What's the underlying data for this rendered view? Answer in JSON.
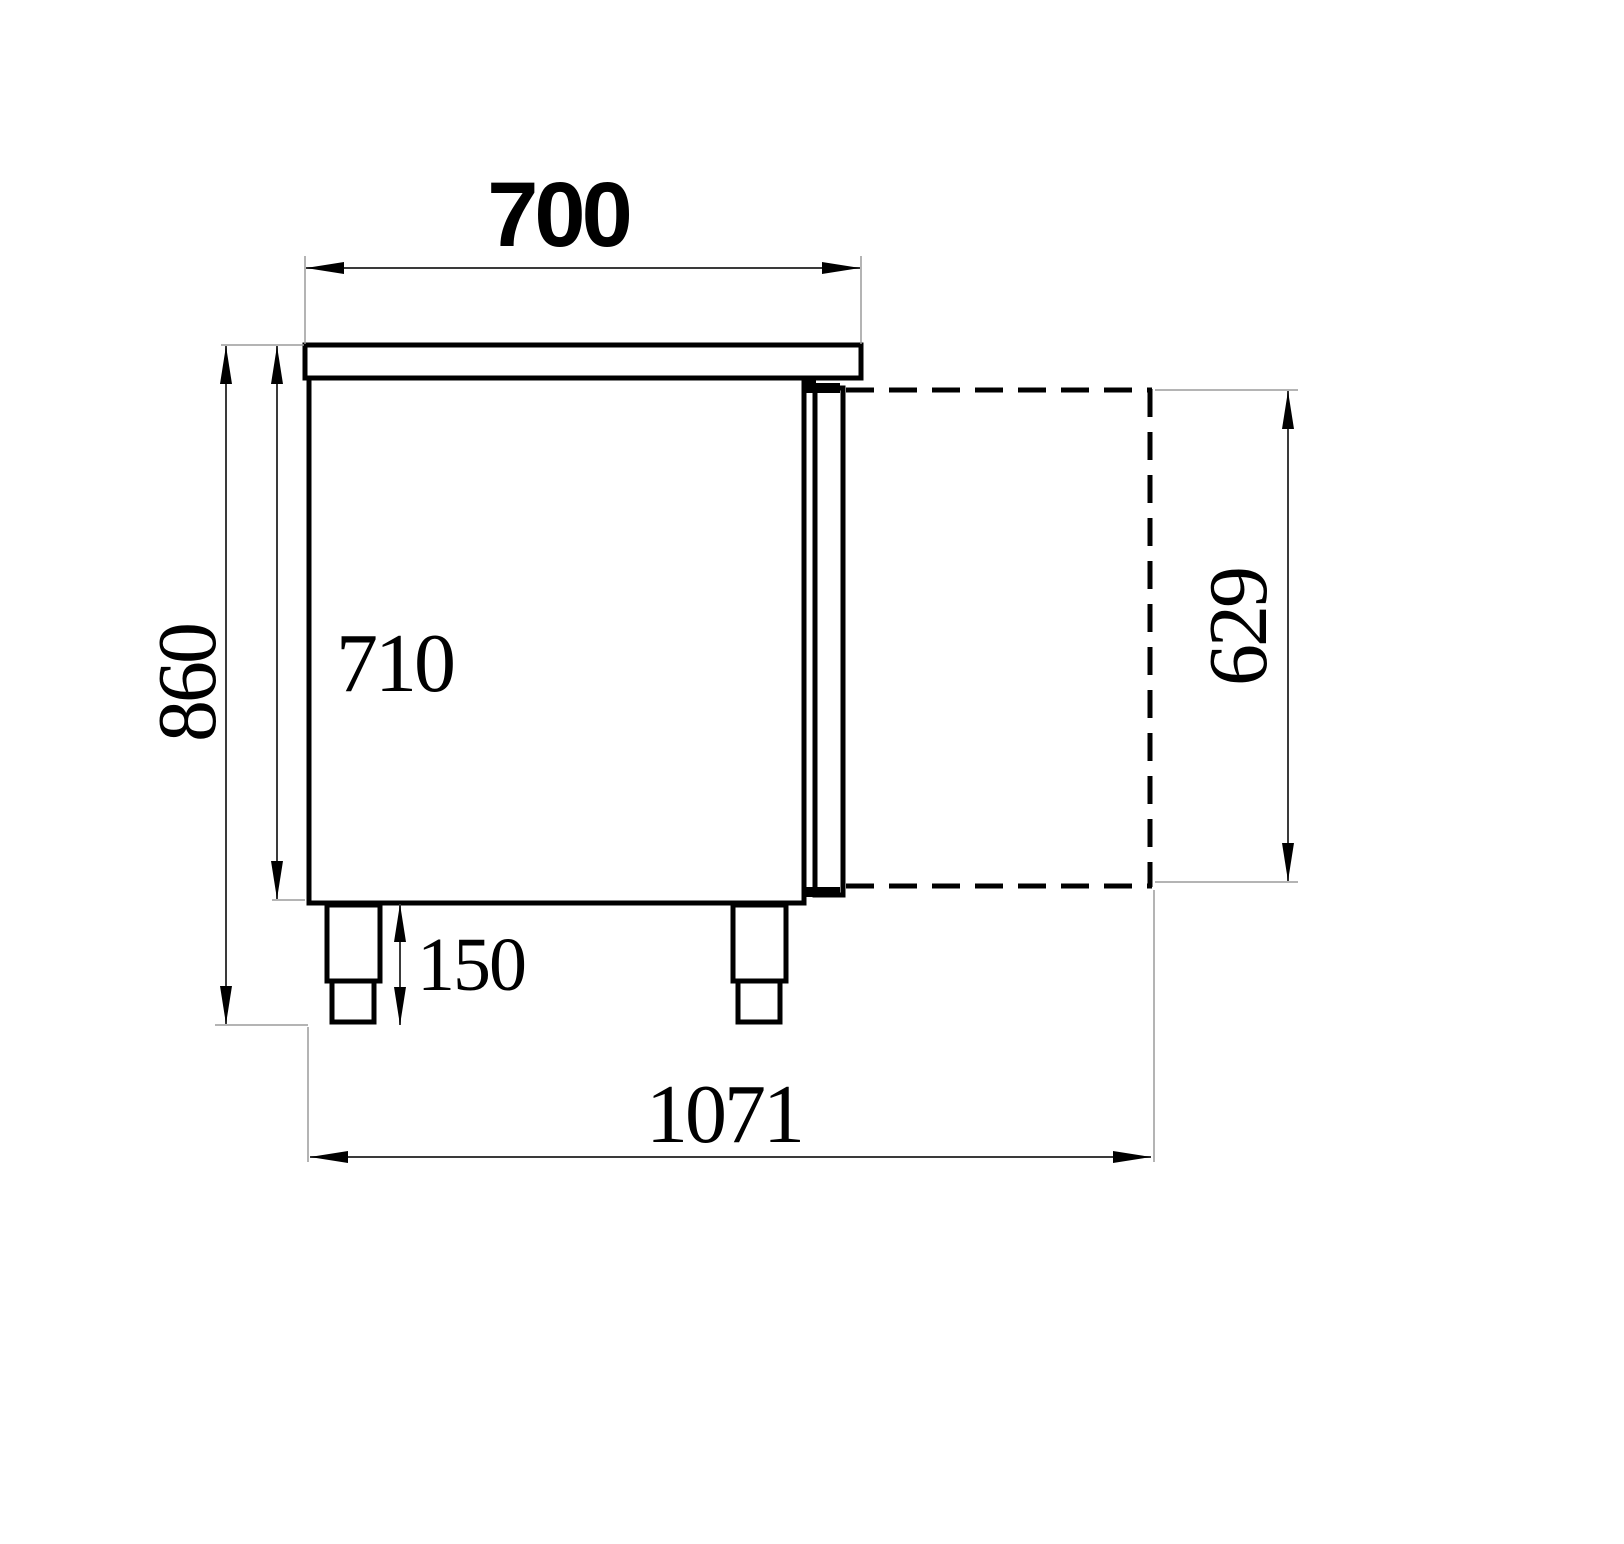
{
  "drawing": {
    "title": "Refrigerated counter side-view technical drawing",
    "dimensions": {
      "top_width": {
        "label": "700",
        "meaning": "countertop depth"
      },
      "total_height": {
        "label": "860",
        "meaning": "overall height"
      },
      "body_height": {
        "label": "710",
        "meaning": "body height without legs"
      },
      "leg_height": {
        "label": "150",
        "meaning": "leg height"
      },
      "door_open_depth": {
        "label": "629",
        "meaning": "open door projection"
      },
      "total_depth_door_open": {
        "label": "1071",
        "meaning": "overall depth with door open"
      }
    },
    "colors": {
      "background": "#ffffff",
      "outline": "#000000",
      "dimension_line": "#3a3a3a",
      "extension_line": "#9b9b9b",
      "text": "#000000"
    }
  }
}
